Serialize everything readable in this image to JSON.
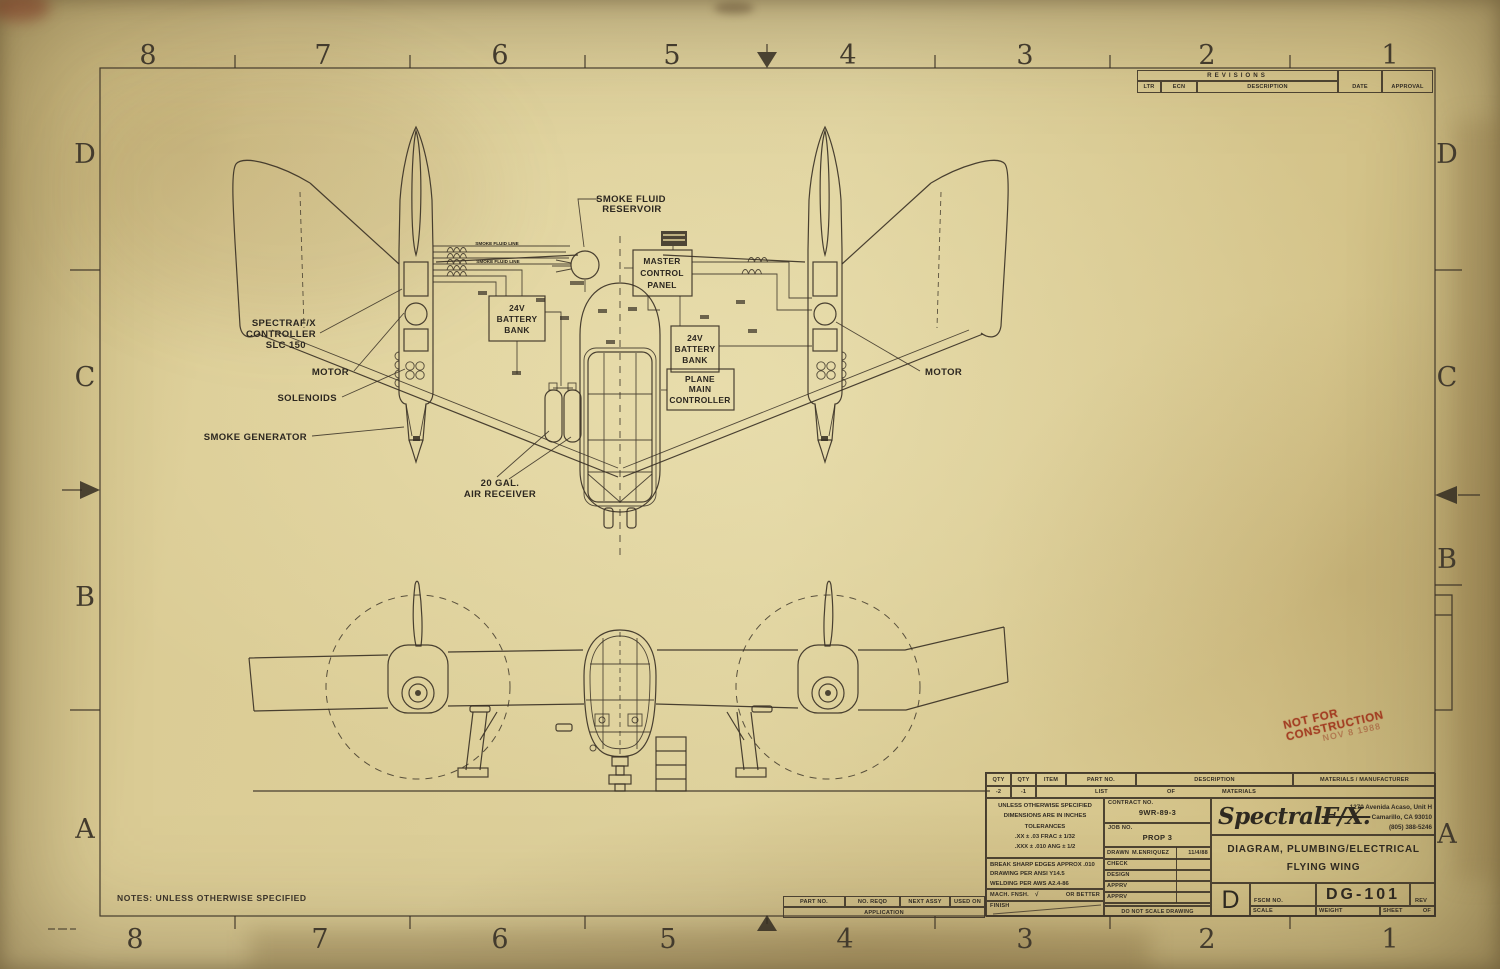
{
  "colors": {
    "paper": "#d9cb94",
    "ink": "#3a3329",
    "stamp_red": "#a8432a"
  },
  "border": {
    "zones_top": [
      "8",
      "7",
      "6",
      "5",
      "4",
      "3",
      "2",
      "1"
    ],
    "zones_bottom": [
      "8",
      "7",
      "6",
      "5",
      "4",
      "3",
      "2",
      "1"
    ],
    "zones_left": [
      "D",
      "C",
      "B",
      "A"
    ],
    "zones_right": [
      "D",
      "C",
      "B",
      "A"
    ]
  },
  "revisions": {
    "title": "REVISIONS",
    "ltr": "LTR",
    "ecn": "ECN",
    "description": "DESCRIPTION",
    "date": "DATE",
    "approval": "APPROVAL"
  },
  "diagram": {
    "smoke_fluid_reservoir": [
      "SMOKE FLUID",
      "RESERVOIR"
    ],
    "master_control_panel": [
      "MASTER",
      "CONTROL",
      "PANEL"
    ],
    "battery_bank_left": [
      "24V",
      "BATTERY",
      "BANK"
    ],
    "battery_bank_right": [
      "24V",
      "BATTERY",
      "BANK"
    ],
    "plane_main_controller": [
      "PLANE",
      "MAIN",
      "CONTROLLER"
    ],
    "spectraf_controller": [
      "SPECTRAF/X",
      "CONTROLLER",
      "SLC 150"
    ],
    "motor_left": "MOTOR",
    "motor_right": "MOTOR",
    "solenoids": "SOLENOIDS",
    "smoke_generator": "SMOKE GENERATOR",
    "air_receiver": [
      "20 GAL.",
      "AIR RECEIVER"
    ],
    "smoke_fluid_line_tag_1": "SMOKE FLUID LINE",
    "smoke_fluid_line_tag_2": "SMOKE FLUID LINE"
  },
  "stamp": {
    "text": "NOT FOR CONSTRUCTION",
    "date": "NOV 8 1988"
  },
  "notes": "NOTES: UNLESS OTHERWISE SPECIFIED",
  "application": {
    "part_no": "PART NO.",
    "no_reqd": "NO. REQD",
    "next_assy": "NEXT ASSY",
    "used_on": "USED ON",
    "application": "APPLICATION"
  },
  "title_block": {
    "lom": {
      "qty_a": "QTY",
      "qty_b": "QTY",
      "item": "ITEM",
      "part_no": "PART NO.",
      "description": "DESCRIPTION",
      "materials": "MATERIALS / MANUFACTURER",
      "dash2": "-2",
      "dash1": "-1",
      "list": "LIST",
      "of": "OF",
      "materials2": "MATERIALS"
    },
    "specs": [
      "UNLESS OTHERWISE SPECIFIED",
      "DIMENSIONS ARE IN INCHES",
      "TOLERANCES",
      ".XX ± .03   FRAC ± 1/32",
      ".XXX ± .010   ANG ± 1/2"
    ],
    "standards": [
      "BREAK SHARP EDGES APPROX .010",
      "DRAWING PER ANSI Y14.5",
      "WELDING PER AWS A2.4-86"
    ],
    "mach_fnsh": "MACH. FNSH.",
    "finish_check": "√",
    "or_better": "OR BETTER",
    "finish": "FINISH",
    "contract_label": "CONTRACT NO.",
    "contract_no": "9WR-89-3",
    "job_label": "JOB NO.",
    "job_no": "PROP 3",
    "drawn_label": "DRAWN",
    "drawn_name": "M.ENRIQUEZ",
    "drawn_date": "11/4/88",
    "check": "CHECK",
    "design": "DESIGN",
    "apprv1": "APPRV",
    "apprv2": "APPRV",
    "do_not_scale": "DO NOT SCALE DRAWING",
    "logo_main": "Spectral",
    "logo_fx": "F/X.",
    "address": [
      "1270 Avenida Acaso, Unit H",
      "Camarillo, CA 93010",
      "(805) 388-5246"
    ],
    "title_line1": "DIAGRAM, PLUMBING/ELECTRICAL",
    "title_line2": "FLYING WING",
    "size": "D",
    "fscm": "FSCM NO.",
    "drawing_no": "DG-101",
    "rev": "REV",
    "scale": "SCALE",
    "weight": "WEIGHT",
    "sheet": "SHEET",
    "of": "OF"
  }
}
